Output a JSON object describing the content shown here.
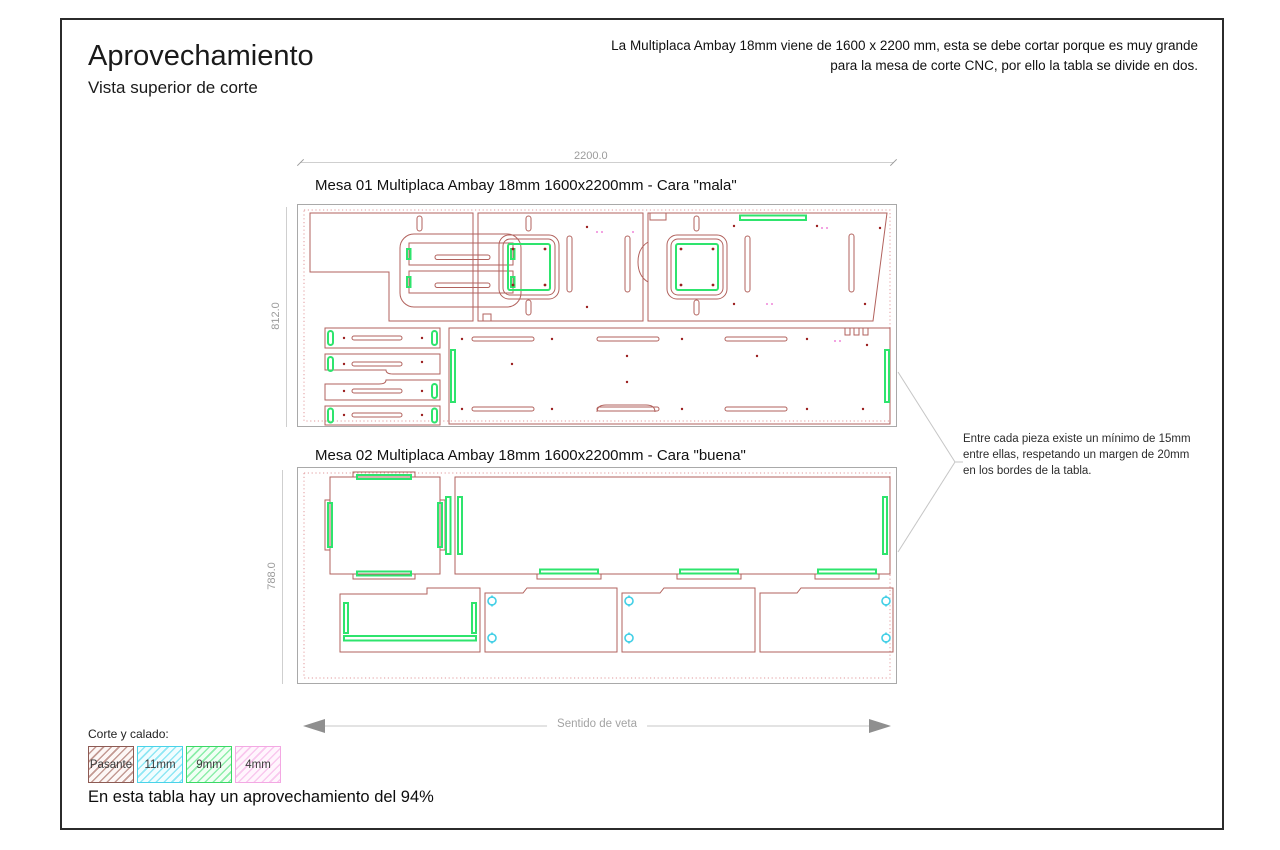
{
  "header": {
    "title": "Aprovechamiento",
    "subtitle": "Vista superior de corte",
    "note": "La Multiplaca Ambay 18mm viene de 1600 x 2200 mm, esta se debe cortar porque es muy grande para la mesa de corte CNC, por ello la tabla se divide en dos."
  },
  "boards": [
    {
      "label": "Mesa 01 Multiplaca Ambay 18mm 1600x2200mm - Cara \"mala\"",
      "width_label": "2200.0",
      "height_label": "812.0"
    },
    {
      "label": "Mesa 02 Multiplaca Ambay 18mm 1600x2200mm - Cara \"buena\"",
      "height_label": "788.0"
    }
  ],
  "annotation": {
    "text": "Entre cada pieza existe un mínimo de 15mm entre ellas, respetando un margen de 20mm en los bordes de la tabla."
  },
  "grain": {
    "label": "Sentido de veta"
  },
  "legend": {
    "title": "Corte y calado:",
    "items": [
      {
        "label": "Pasante",
        "color": "#8d5b54"
      },
      {
        "label": "11mm",
        "color": "#49d3e8"
      },
      {
        "label": "9mm",
        "color": "#3bd966"
      },
      {
        "label": "4mm",
        "color": "#f3a8e3"
      }
    ]
  },
  "footer": {
    "note": "En esta tabla hay un aprovechamiento del 94%"
  },
  "colors": {
    "cut_outline": "#b2625d",
    "margin_dotted": "#e29a9c",
    "highlight_9mm": "#2ee46d",
    "highlight_11mm": "#43cfe6",
    "highlight_4mm": "#ef86d8",
    "drill_dot": "#9b1f1f",
    "dimension_gray": "#9b9b9b",
    "frame_border": "#2b2b2b"
  }
}
